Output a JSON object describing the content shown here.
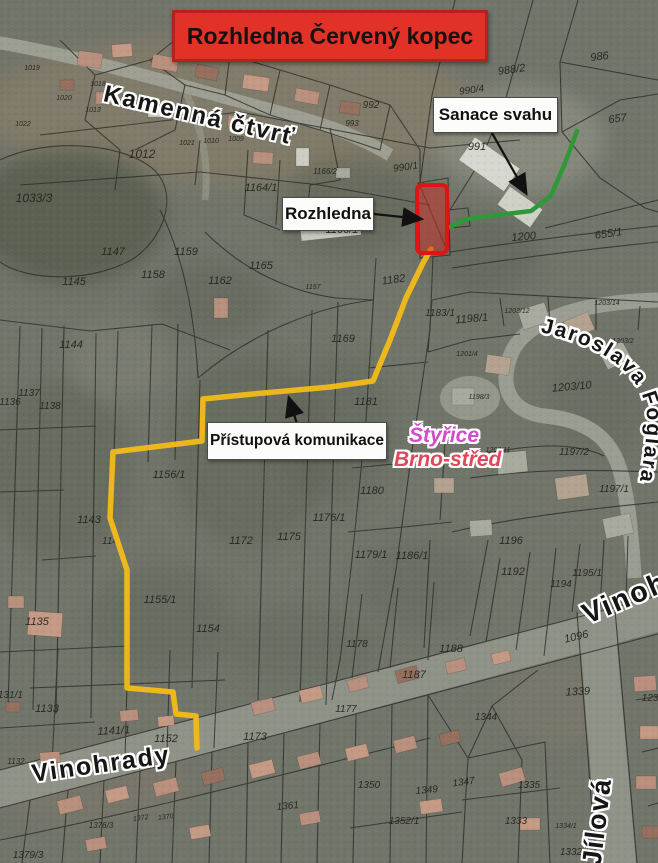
{
  "title": {
    "text": "Rozhledna Červený kopec"
  },
  "annotations": {
    "sanace": "Sanace svahu",
    "rozhledna": "Rozhledna",
    "pristupova": "Přístupová komunikace"
  },
  "area_labels": {
    "styrice": "Štyřice",
    "brno_stred": "Brno-střed"
  },
  "streets": {
    "kamenna": "Kamenná čtvrť",
    "vinohrady_left": "Vinohrady",
    "vinohrady_right": "Vinohrady",
    "jilova": "Jílová",
    "foglara": "Jaroslava Foglara"
  },
  "colors": {
    "title_bg": "#e23227",
    "title_border": "#b5221b",
    "access_path": "#f3bc19",
    "sanace_line": "#2f9838",
    "tower_stroke": "#e01414",
    "styrice_text": "#d24bc8",
    "brno_stred_text": "#e0475a",
    "arrow": "#111111"
  },
  "map": {
    "parcels": [
      {
        "n": "1019",
        "x": 32,
        "y": 70,
        "s": 7
      },
      {
        "n": "1018",
        "x": 98,
        "y": 86,
        "s": 7
      },
      {
        "n": "1020",
        "x": 64,
        "y": 100,
        "s": 7
      },
      {
        "n": "1013",
        "x": 93,
        "y": 112,
        "s": 7
      },
      {
        "n": "1022",
        "x": 23,
        "y": 126,
        "s": 7
      },
      {
        "n": "1021",
        "x": 187,
        "y": 145,
        "s": 7
      },
      {
        "n": "1010",
        "x": 211,
        "y": 143,
        "s": 7
      },
      {
        "n": "1009",
        "x": 236,
        "y": 141,
        "s": 7
      },
      {
        "n": "1012",
        "x": 142,
        "y": 158,
        "s": 12
      },
      {
        "n": "1033/3",
        "x": 34,
        "y": 202,
        "s": 12
      },
      {
        "n": "992",
        "x": 371,
        "y": 108,
        "s": 10
      },
      {
        "n": "993",
        "x": 352,
        "y": 126,
        "s": 8
      },
      {
        "n": "990/4",
        "x": 472,
        "y": 93,
        "s": 10,
        "r": -8
      },
      {
        "n": "991",
        "x": 477,
        "y": 150,
        "s": 11
      },
      {
        "n": "990/1",
        "x": 406,
        "y": 170,
        "s": 10,
        "r": -8
      },
      {
        "n": "988/2",
        "x": 512,
        "y": 73,
        "s": 11,
        "r": -8
      },
      {
        "n": "986",
        "x": 600,
        "y": 60,
        "s": 11,
        "r": -8
      },
      {
        "n": "657",
        "x": 618,
        "y": 122,
        "s": 11,
        "r": -8
      },
      {
        "n": "655/1",
        "x": 609,
        "y": 237,
        "s": 11,
        "r": -8
      },
      {
        "n": "1200",
        "x": 524,
        "y": 240,
        "s": 11,
        "r": -5
      },
      {
        "n": "1164/1",
        "x": 261,
        "y": 191,
        "s": 11
      },
      {
        "n": "1166/2",
        "x": 325,
        "y": 174,
        "s": 8
      },
      {
        "n": "1166/1",
        "x": 342,
        "y": 233,
        "s": 11
      },
      {
        "n": "1157",
        "x": 313,
        "y": 289,
        "s": 7
      },
      {
        "n": "1182",
        "x": 394,
        "y": 283,
        "s": 11,
        "r": -8
      },
      {
        "n": "1147",
        "x": 113,
        "y": 255,
        "s": 11
      },
      {
        "n": "1159",
        "x": 186,
        "y": 255,
        "s": 11
      },
      {
        "n": "1145",
        "x": 74,
        "y": 285,
        "s": 11
      },
      {
        "n": "1158",
        "x": 153,
        "y": 278,
        "s": 11
      },
      {
        "n": "1162",
        "x": 220,
        "y": 284,
        "s": 11
      },
      {
        "n": "1165",
        "x": 261,
        "y": 269,
        "s": 11
      },
      {
        "n": "1144",
        "x": 71,
        "y": 348,
        "s": 11
      },
      {
        "n": "1136",
        "x": 10,
        "y": 405,
        "s": 10
      },
      {
        "n": "1137",
        "x": 29,
        "y": 396,
        "s": 10
      },
      {
        "n": "1138",
        "x": 50,
        "y": 409,
        "s": 10
      },
      {
        "n": "1143",
        "x": 89,
        "y": 523,
        "s": 11
      },
      {
        "n": "114",
        "x": 110,
        "y": 544,
        "s": 10
      },
      {
        "n": "1156/1",
        "x": 169,
        "y": 478,
        "s": 11
      },
      {
        "n": "1172",
        "x": 241,
        "y": 544,
        "s": 11
      },
      {
        "n": "1175",
        "x": 289,
        "y": 540,
        "s": 11
      },
      {
        "n": "1176/1",
        "x": 329,
        "y": 521,
        "s": 11
      },
      {
        "n": "1169",
        "x": 343,
        "y": 342,
        "s": 11
      },
      {
        "n": "1181",
        "x": 366,
        "y": 405,
        "s": 11
      },
      {
        "n": "1180",
        "x": 372,
        "y": 494,
        "s": 11
      },
      {
        "n": "1179/1",
        "x": 371,
        "y": 558,
        "s": 11
      },
      {
        "n": "1186/1",
        "x": 412,
        "y": 559,
        "s": 11
      },
      {
        "n": "1178",
        "x": 357,
        "y": 647,
        "s": 10
      },
      {
        "n": "1183/1",
        "x": 440,
        "y": 316,
        "s": 10
      },
      {
        "n": "1198/1",
        "x": 472,
        "y": 322,
        "s": 11,
        "r": -5
      },
      {
        "n": "1201/4",
        "x": 467,
        "y": 356,
        "s": 7
      },
      {
        "n": "1198/3",
        "x": 479,
        "y": 399,
        "s": 7
      },
      {
        "n": "1203/12",
        "x": 517,
        "y": 313,
        "s": 7
      },
      {
        "n": "1203/14",
        "x": 607,
        "y": 305,
        "s": 7
      },
      {
        "n": "1203/2",
        "x": 623,
        "y": 343,
        "s": 7
      },
      {
        "n": "1203/10",
        "x": 572,
        "y": 390,
        "s": 11,
        "r": -5
      },
      {
        "n": "1203/11",
        "x": 498,
        "y": 452,
        "s": 7
      },
      {
        "n": "1197/2",
        "x": 574,
        "y": 455,
        "s": 10
      },
      {
        "n": "1197/1",
        "x": 614,
        "y": 492,
        "s": 10
      },
      {
        "n": "1196",
        "x": 511,
        "y": 544,
        "s": 11
      },
      {
        "n": "1192",
        "x": 513,
        "y": 575,
        "s": 11
      },
      {
        "n": "1194",
        "x": 561,
        "y": 587,
        "s": 10
      },
      {
        "n": "1195/1",
        "x": 587,
        "y": 576,
        "s": 10
      },
      {
        "n": "1188",
        "x": 451,
        "y": 652,
        "s": 11
      },
      {
        "n": "1187",
        "x": 414,
        "y": 678,
        "s": 11
      },
      {
        "n": "1177",
        "x": 346,
        "y": 712,
        "s": 10
      },
      {
        "n": "1096",
        "x": 577,
        "y": 640,
        "s": 11,
        "r": -13
      },
      {
        "n": "1344",
        "x": 486,
        "y": 720,
        "s": 10
      },
      {
        "n": "1339",
        "x": 578,
        "y": 695,
        "s": 11,
        "r": -3
      },
      {
        "n": "1135",
        "x": 37,
        "y": 625,
        "s": 11
      },
      {
        "n": "1133",
        "x": 47,
        "y": 712,
        "s": 11
      },
      {
        "n": "1131/1",
        "x": 8,
        "y": 698,
        "s": 10
      },
      {
        "n": "1141/1",
        "x": 114,
        "y": 734,
        "s": 11,
        "r": -3
      },
      {
        "n": "1152",
        "x": 166,
        "y": 742,
        "s": 11
      },
      {
        "n": "1132",
        "x": 16,
        "y": 764,
        "s": 8
      },
      {
        "n": "1155/1",
        "x": 160,
        "y": 603,
        "s": 11
      },
      {
        "n": "1154",
        "x": 208,
        "y": 632,
        "s": 11
      },
      {
        "n": "1173",
        "x": 255,
        "y": 740,
        "s": 11
      },
      {
        "n": "1350",
        "x": 369,
        "y": 788,
        "s": 10
      },
      {
        "n": "1349",
        "x": 427,
        "y": 793,
        "s": 10,
        "r": -5
      },
      {
        "n": "1347",
        "x": 464,
        "y": 785,
        "s": 10,
        "r": -8
      },
      {
        "n": "1335",
        "x": 529,
        "y": 788,
        "s": 10
      },
      {
        "n": "1352/1",
        "x": 404,
        "y": 824,
        "s": 10
      },
      {
        "n": "1333",
        "x": 516,
        "y": 824,
        "s": 10
      },
      {
        "n": "1334/1",
        "x": 566,
        "y": 828,
        "s": 7
      },
      {
        "n": "1332",
        "x": 571,
        "y": 855,
        "s": 10
      },
      {
        "n": "1379/3",
        "x": 28,
        "y": 858,
        "s": 10
      },
      {
        "n": "1376/3",
        "x": 101,
        "y": 828,
        "s": 8
      },
      {
        "n": "1372",
        "x": 141,
        "y": 820,
        "s": 7,
        "r": -8
      },
      {
        "n": "1370",
        "x": 166,
        "y": 819,
        "s": 7,
        "r": -8
      },
      {
        "n": "1361",
        "x": 288,
        "y": 809,
        "s": 10,
        "r": -5
      },
      {
        "n": "123",
        "x": 650,
        "y": 701,
        "s": 10
      }
    ]
  }
}
